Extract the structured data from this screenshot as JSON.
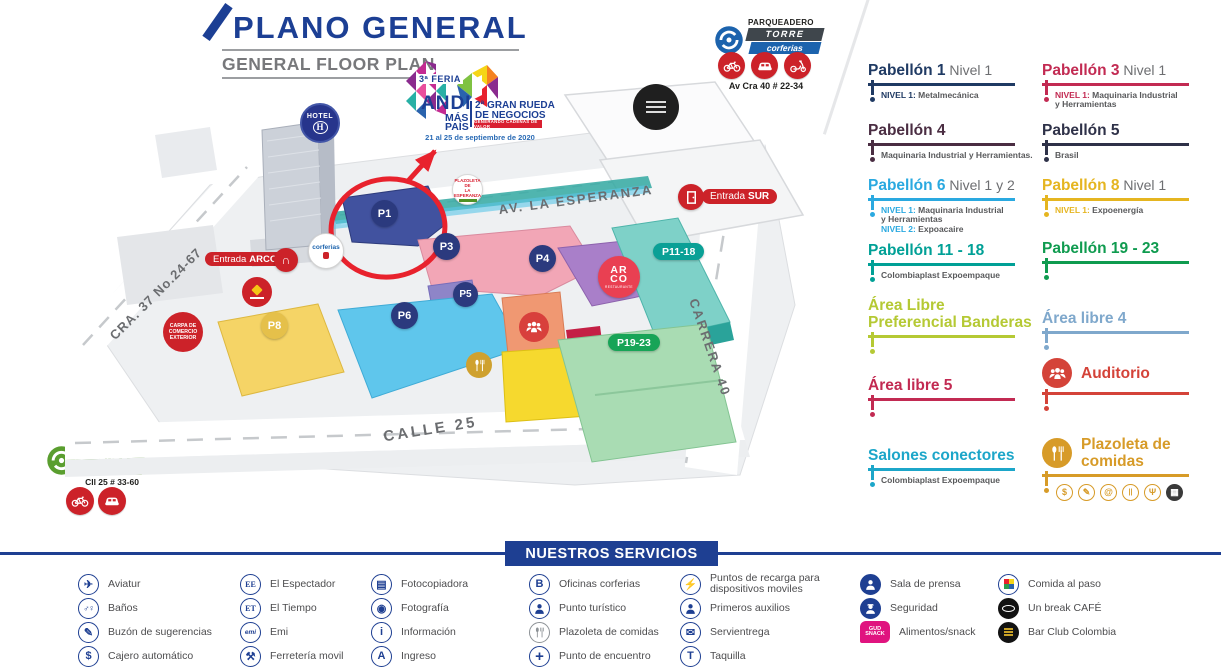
{
  "header": {
    "title": "PLANO GENERAL",
    "subtitle": "GENERAL FLOOR PLAN"
  },
  "event": {
    "feria": "3ª FERIA",
    "brand": "ANDI",
    "brand2": "MÁS",
    "brand3": "PAÍS",
    "rueda1": "2ª GRAN RUEDA",
    "rueda2": "DE NEGOCIOS",
    "banner": "GENERANDO CADENAS DE VALOR",
    "dates": "21 al 25 de septiembre de 2020"
  },
  "parking_torre": {
    "label": "PARQUEADERO",
    "name": "TORRE",
    "brand": "corferias",
    "address": "Av Cra 40 # 22-34",
    "vehicles": [
      "bike",
      "car",
      "moto"
    ]
  },
  "parking_verde": {
    "label": "PARQUEADERO",
    "name": "VERDE",
    "brand": "corferias",
    "address": "Cll 25 # 33-60",
    "vehicles": [
      "bike",
      "car"
    ]
  },
  "map": {
    "streets": {
      "esperanza": "AV. LA ESPERANZA",
      "carrera40": "CARRERA 40",
      "calle25": "CALLE 25",
      "cra37": "CRA. 37 No.24-67"
    },
    "entrance_arco": {
      "prefix": "Entrada",
      "name": "ARCO"
    },
    "entrance_sur": {
      "prefix": "Entrada",
      "name": "SUR"
    },
    "hotel": "HOTEL",
    "hotel_mark": "H",
    "corferias_badge": "corferias",
    "carpa": [
      "CARPA DE",
      "COMERCIO",
      "EXTERIOR"
    ],
    "plazoleta_sign": [
      "PLAZOLETA DE",
      "LA ESPERANZA"
    ],
    "arco_rest": {
      "l1": "AR",
      "l2": "CO",
      "sub": "RESTAURANTE"
    },
    "pavilions": {
      "p1": "P1",
      "p3": "P3",
      "p4": "P4",
      "p5": "P5",
      "p6": "P6",
      "p8": "P8",
      "p1118": "P11-18",
      "p1923": "P19-23"
    }
  },
  "legend": {
    "col1": [
      {
        "title": "Pabellón 1",
        "suffix": "Nivel 1",
        "color": "#1f3a63",
        "subs": [
          {
            "pre": "NIVEL 1:",
            "text": "Metalmecánica"
          }
        ]
      },
      {
        "title": "Pabellón 4",
        "color": "#4a2d42",
        "subs": [
          {
            "pre": "",
            "text": "Maquinaria Industrial y Herramientas."
          }
        ]
      },
      {
        "title": "Pabellón 6",
        "suffix": "Nivel 1 y 2",
        "color": "#2aa9e0",
        "subs": [
          {
            "pre": "NIVEL 1:",
            "text": "Maquinaria Industrial"
          },
          {
            "pre": "",
            "text": "y Herramientas"
          },
          {
            "pre": "NIVEL 2:",
            "text": "Expoacaire"
          }
        ]
      },
      {
        "title": "Pabellón 11 - 18",
        "color": "#00a096",
        "subs": [
          {
            "pre": "",
            "text": "Colombiaplast Expoempaque"
          }
        ]
      },
      {
        "title": "Área Libre Preferencial Banderas",
        "color": "#b5c934"
      },
      {
        "title": "Área libre 5",
        "color": "#c22a52"
      },
      {
        "title": "Salones conectores",
        "color": "#1ca6c9",
        "subs": [
          {
            "pre": "",
            "text": "Colombiaplast Expoempaque"
          }
        ]
      }
    ],
    "col2": [
      {
        "title": "Pabellón 3",
        "suffix": "Nivel 1",
        "color": "#c22a52",
        "subs": [
          {
            "pre": "NIVEL 1:",
            "text": "Maquinaria Industrial"
          },
          {
            "pre": "",
            "text": "y Herramientas"
          }
        ]
      },
      {
        "title": "Pabellón 5",
        "color": "#2e3148",
        "subs": [
          {
            "pre": "",
            "text": "Brasil"
          }
        ]
      },
      {
        "title": "Pabellón 8",
        "suffix": "Nivel 1",
        "color": "#e5b520",
        "subs": [
          {
            "pre": "NIVEL 1:",
            "text": "Expoenergía"
          }
        ]
      },
      {
        "title": "Pabellón 19 - 23",
        "color": "#0f9b4f"
      },
      {
        "title": "Área libre 4",
        "color": "#7fa8cc"
      },
      {
        "title": "Auditorio",
        "color": "#d44339",
        "icon": "people"
      },
      {
        "title": "Plazoleta de comidas",
        "color": "#d79b28",
        "icon": "cutlery",
        "mini_icons": [
          "dollar",
          "pencil",
          "at",
          "bars",
          "fork",
          "market"
        ]
      }
    ]
  },
  "services": {
    "banner": "NUESTROS SERVICIOS",
    "items": [
      {
        "icon": "plane",
        "label": "Aviatur"
      },
      {
        "icon": "restroom",
        "label": "Baños"
      },
      {
        "icon": "pencil",
        "label": "Buzón de sugerencias"
      },
      {
        "icon": "dollar",
        "label": "Cajero automático"
      },
      {
        "icon": "text-EE",
        "label": "El Espectador"
      },
      {
        "icon": "text-ET",
        "label": "El Tiempo"
      },
      {
        "icon": "text-emi",
        "label": "Emi"
      },
      {
        "icon": "hammer",
        "label": "Ferretería movil"
      },
      {
        "icon": "copier",
        "label": "Fotocopiadora"
      },
      {
        "icon": "camera",
        "label": "Fotografía"
      },
      {
        "icon": "text-i",
        "label": "Información"
      },
      {
        "icon": "text-A",
        "label": "Ingreso"
      },
      {
        "icon": "text-B",
        "label": "Oficinas corferias"
      },
      {
        "icon": "tourist",
        "label": "Punto turístico"
      },
      {
        "icon": "cutlery-gray",
        "label": "Plazoleta de comidas"
      },
      {
        "icon": "meeting",
        "label": "Punto de encuentro"
      },
      {
        "icon": "plug",
        "label": "Puntos de recarga para dispositivos moviles"
      },
      {
        "icon": "firstaid",
        "label": "Primeros auxilios"
      },
      {
        "icon": "envelope",
        "label": "Servientrega"
      },
      {
        "icon": "text-T",
        "label": "Taquilla"
      },
      {
        "icon": "press",
        "label": "Sala de prensa"
      },
      {
        "icon": "security",
        "label": "Seguridad"
      },
      {
        "icon": "gudsnack",
        "label": "Alimentos/snack",
        "icon_text": "GUD SNACK"
      },
      null,
      {
        "icon": "foodtogo",
        "label": "Comida al paso"
      },
      {
        "icon": "oma",
        "label": "Un break CAFÉ"
      },
      {
        "icon": "barclub",
        "label": "Bar Club Colombia"
      },
      null
    ]
  }
}
